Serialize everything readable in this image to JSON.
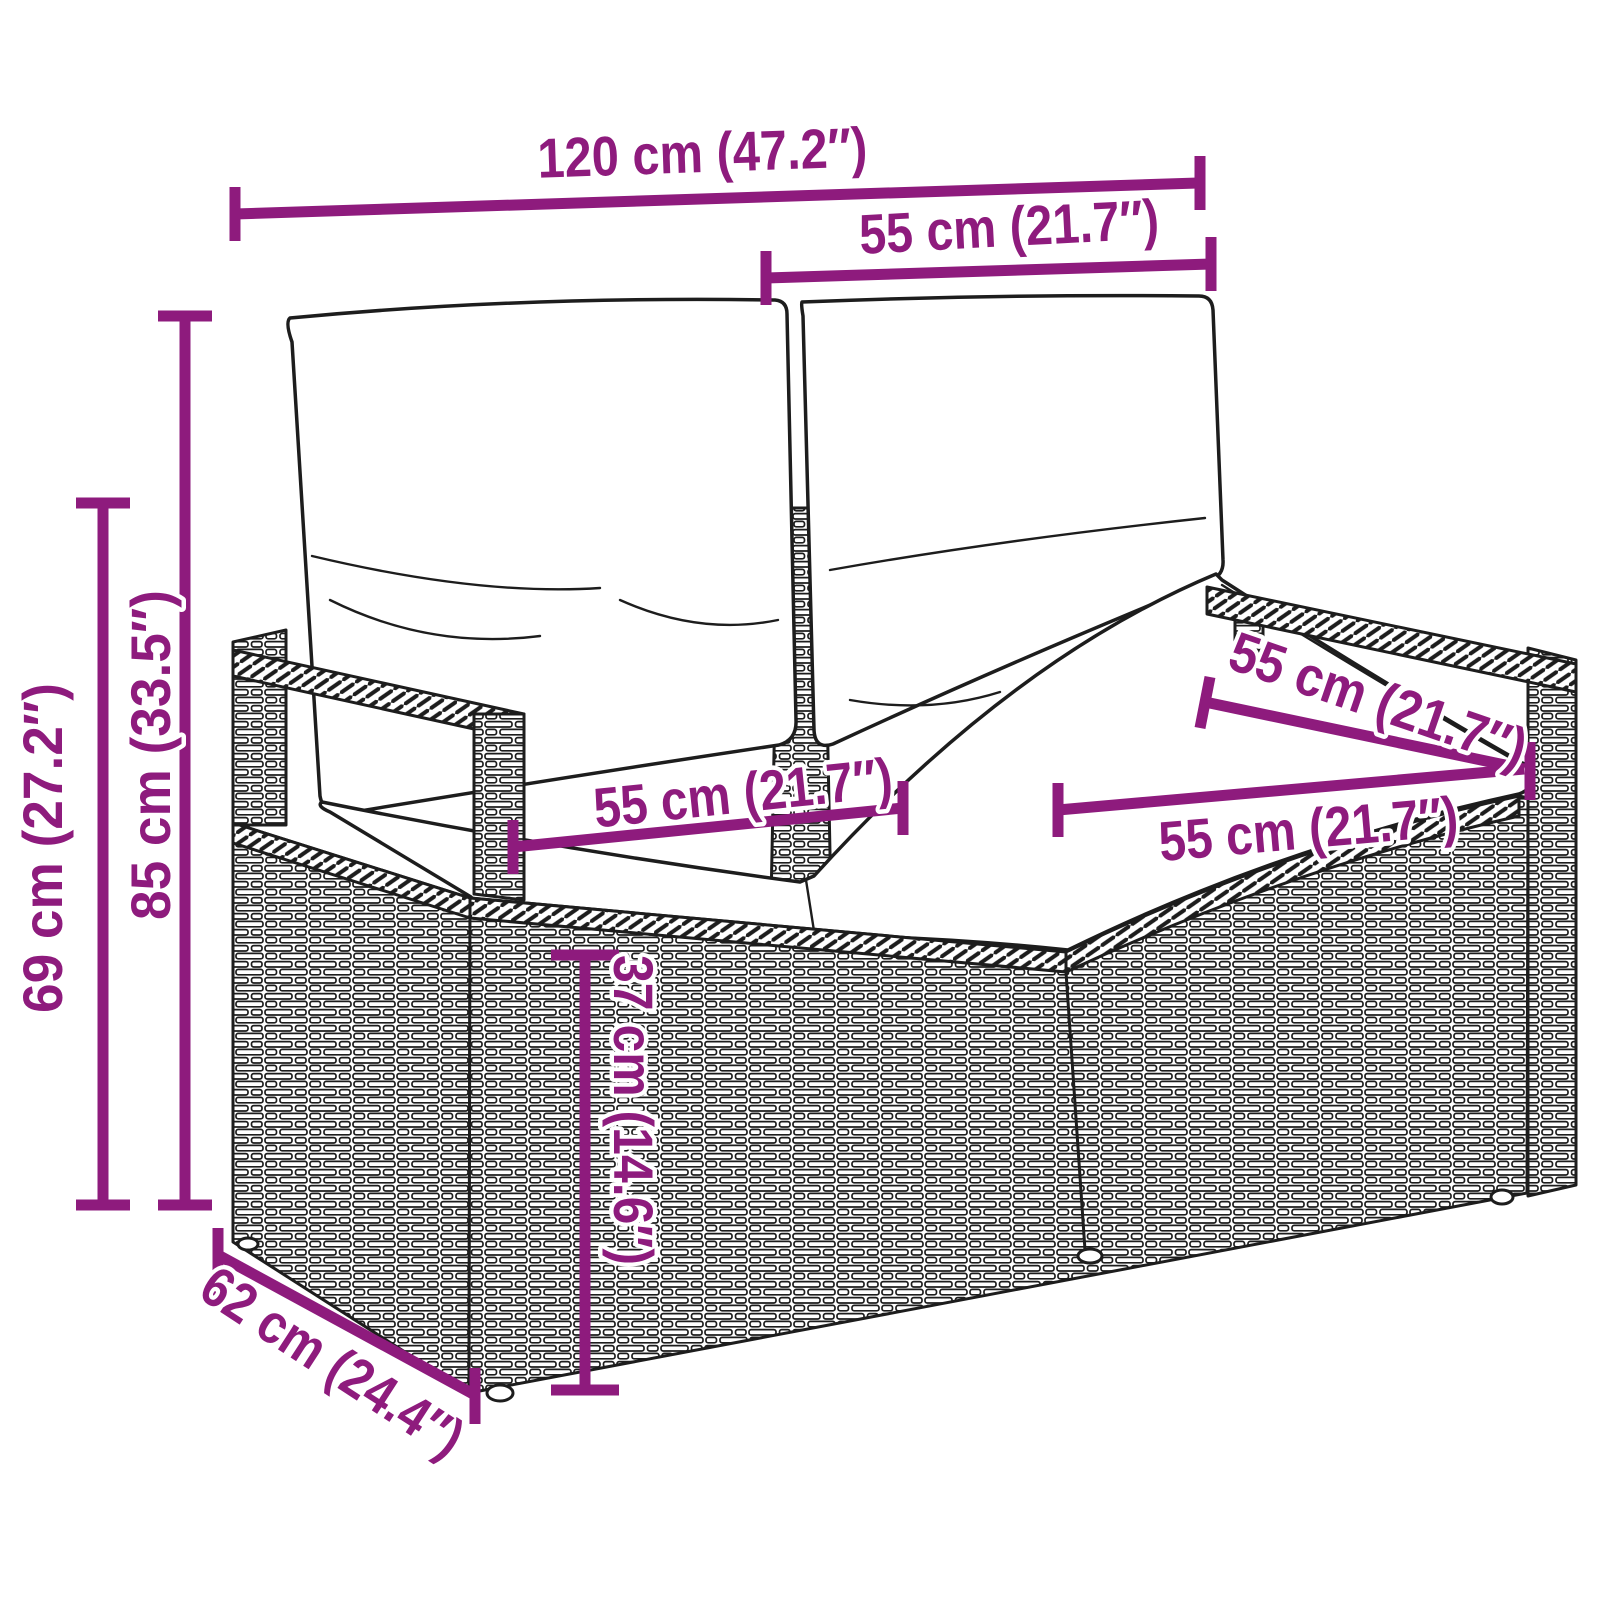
{
  "diagram": {
    "type": "product-dimension-diagram",
    "subject": "2-seater poly rattan garden bench with back and seat cushions",
    "style": "black line-art drawing with magenta dimension lines"
  },
  "colors": {
    "dimension": "#8e1b7d",
    "outline": "#1d1d1d",
    "background": "#ffffff",
    "cushion_fill": "#ffffff"
  },
  "dimensions": {
    "overall_width": {
      "label": "120 cm (47.2″)",
      "cm": 120,
      "inches": 47.2,
      "measures": "overall width"
    },
    "back_cushion_width": {
      "label": "55 cm (21.7″)",
      "cm": 55,
      "inches": 21.7,
      "measures": "backrest cushion width"
    },
    "total_height": {
      "label": "85 cm (33.5″)",
      "cm": 85,
      "inches": 33.5,
      "measures": "total height"
    },
    "armrest_height": {
      "label": "69 cm (27.2″)",
      "cm": 69,
      "inches": 27.2,
      "measures": "armrest height"
    },
    "seat_width_left": {
      "label": "55 cm (21.7″)",
      "cm": 55,
      "inches": 21.7,
      "measures": "left seat cushion width"
    },
    "seat_width_right": {
      "label": "55 cm (21.7″)",
      "cm": 55,
      "inches": 21.7,
      "measures": "right seat cushion width"
    },
    "seat_depth": {
      "label": "55 cm (21.7″)",
      "cm": 55,
      "inches": 21.7,
      "measures": "seat depth"
    },
    "seat_height": {
      "label": "37 cm (14.6″)",
      "cm": 37,
      "inches": 14.6,
      "measures": "seat height"
    },
    "overall_depth": {
      "label": "62 cm (24.4″)",
      "cm": 62,
      "inches": 24.4,
      "measures": "overall depth"
    }
  }
}
